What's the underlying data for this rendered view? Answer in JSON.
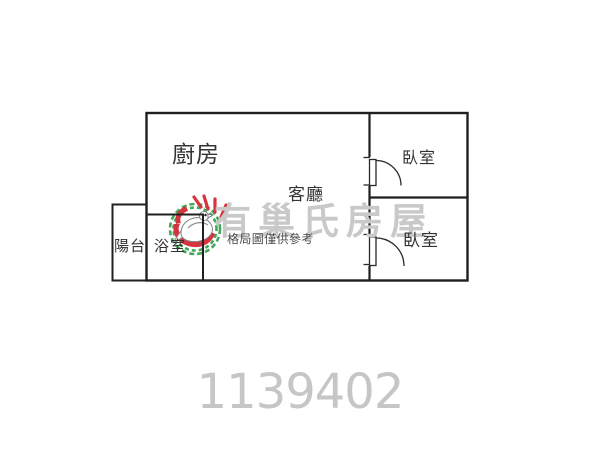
{
  "watermark": {
    "brand": "有巢氏房屋",
    "logo": "dove-hand-circle-logo",
    "text_color": "#c9c9c9",
    "logo_green": "#33a04c",
    "logo_red": "#d2232f"
  },
  "floorplan": {
    "disclaimer": "格局圖僅供參考",
    "wall_color": "#1f1f1f",
    "rooms": [
      {
        "id": "kitchen",
        "label": "廚房"
      },
      {
        "id": "living-room",
        "label": "客廳"
      },
      {
        "id": "bedroom-upper",
        "label": "臥室"
      },
      {
        "id": "bedroom-lower",
        "label": "臥室"
      },
      {
        "id": "balcony",
        "label": "陽台"
      },
      {
        "id": "bathroom",
        "label": "浴室"
      }
    ]
  },
  "listing_id": {
    "value": "1139402",
    "color": "#c6c6c6"
  }
}
